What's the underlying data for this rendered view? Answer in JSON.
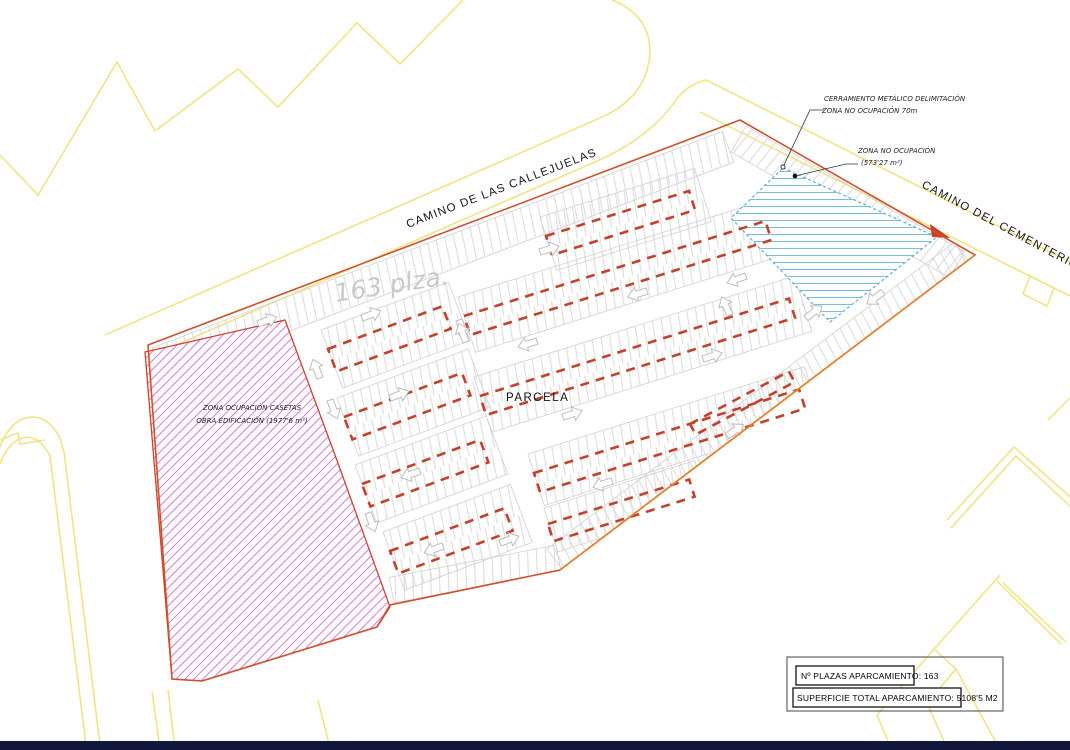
{
  "plan": {
    "road_labels": {
      "callejuelas": "CAMINO DE LAS CALLEJUELAS",
      "cementerio": "CAMINO DEL CEMENTERIO"
    },
    "parcel_label": "PARCELA",
    "capacity_note": "163 plza.",
    "callout": {
      "line1": "CERRAMIENTO METÁLICO DELIMITACIÓN",
      "line2": "ZONA NO OCUPACIÓN 70m"
    },
    "zona_no_ocupacion": {
      "label": "ZONA NO OCUPACIÓN",
      "area": "(573'27 m²)"
    },
    "zona_ocupacion": {
      "line1": "ZONA OCUPACIÓN CASETAS",
      "line2": "OBRA EDIFICACIÓN (1977'6 m²)"
    },
    "summary": {
      "plazas": "Nº PLAZAS APARCAMIENTO: 163",
      "superficie": "SUPERFICIE TOTAL APARCAMIENTO: 5108'5 M2"
    },
    "colors": {
      "parcel_boundary": "#d0502a",
      "row_marking": "#c4402a",
      "cadastral": "#f2e27d",
      "stall_line": "#d8d8d8",
      "no_ocupacion_hatch": "#74bede",
      "ocupacion_hatch": "#d473d4",
      "note_gray": "#c9c9c9"
    }
  }
}
